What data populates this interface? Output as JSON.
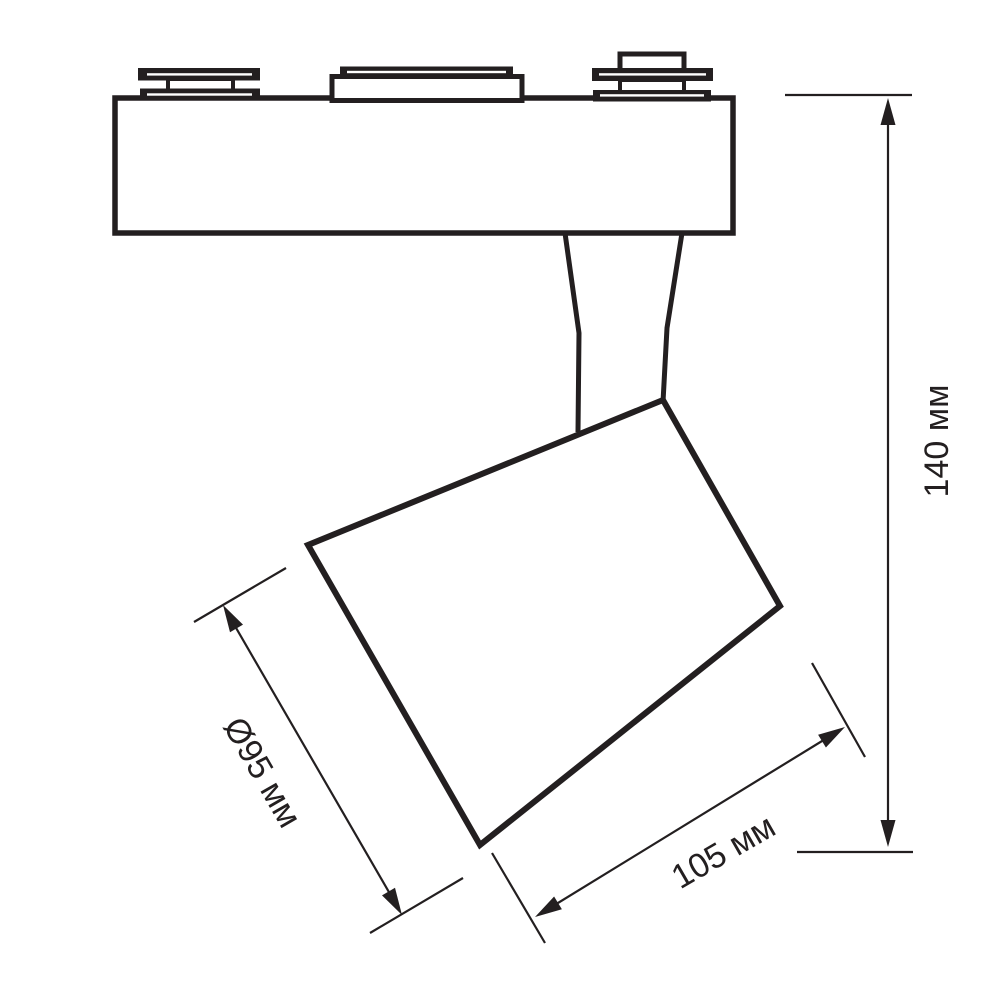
{
  "drawing": {
    "labels": {
      "height": "140 мм",
      "length": "105 мм",
      "diameter": "Ø95 мм"
    },
    "colors": {
      "line": "#231f20",
      "background": "#ffffff"
    }
  }
}
